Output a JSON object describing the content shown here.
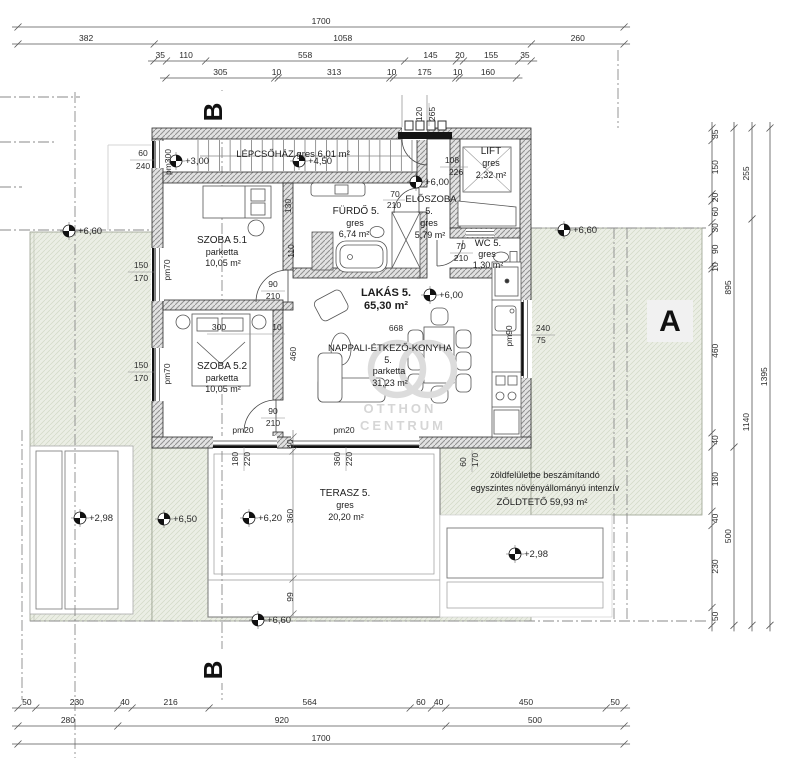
{
  "page": {
    "type": "architectural-floor-plan",
    "level": "emelet"
  },
  "watermark": {
    "monogram": "OC",
    "line1": "OTTHON",
    "line2": "CENTRUM"
  },
  "section_markers": [
    {
      "label": "B",
      "x": 222,
      "y": 112,
      "r": -90,
      "s": 26
    },
    {
      "label": "B",
      "x": 222,
      "y": 670,
      "r": -90,
      "s": 26
    },
    {
      "label": "A",
      "x": 670,
      "y": 331,
      "r": 0,
      "s": 30
    }
  ],
  "level_markers": [
    {
      "value": "+3,00",
      "x": 176,
      "y": 161
    },
    {
      "value": "+4,50",
      "x": 299,
      "y": 161
    },
    {
      "value": "+6,00",
      "x": 416,
      "y": 182
    },
    {
      "value": "+6,00",
      "x": 430,
      "y": 295
    },
    {
      "value": "+6,60",
      "x": 69,
      "y": 231
    },
    {
      "value": "+6,60",
      "x": 564,
      "y": 230
    },
    {
      "value": "+2,98",
      "x": 80,
      "y": 518
    },
    {
      "value": "+6,50",
      "x": 164,
      "y": 519
    },
    {
      "value": "+6,20",
      "x": 249,
      "y": 518
    },
    {
      "value": "+2,98",
      "x": 515,
      "y": 554
    },
    {
      "value": "+6,60",
      "x": 258,
      "y": 620
    }
  ],
  "room_labels": [
    {
      "t": "LÉPCSŐHÁZ gres 6,01 m²",
      "x": 293,
      "y": 157,
      "s": 9.5
    },
    {
      "t": "SZOBA 5.1",
      "x": 222,
      "y": 243,
      "s": 10
    },
    {
      "t": "parketta",
      "x": 222,
      "y": 255,
      "s": 9
    },
    {
      "t": "10,05 m²",
      "x": 223,
      "y": 266,
      "s": 9
    },
    {
      "t": "FÜRDŐ 5.",
      "x": 356,
      "y": 214,
      "s": 10
    },
    {
      "t": "gres",
      "x": 355,
      "y": 226,
      "s": 9
    },
    {
      "t": "6,74 m²",
      "x": 354,
      "y": 237,
      "s": 9
    },
    {
      "t": "ELŐSZOBA",
      "x": 431,
      "y": 202,
      "s": 9.5
    },
    {
      "t": "5.",
      "x": 429,
      "y": 214,
      "s": 9
    },
    {
      "t": "gres",
      "x": 429,
      "y": 226,
      "s": 9
    },
    {
      "t": "5,79 m²",
      "x": 430,
      "y": 238,
      "s": 9
    },
    {
      "t": "LIFT",
      "x": 491,
      "y": 154,
      "s": 10
    },
    {
      "t": "gres",
      "x": 491,
      "y": 166,
      "s": 9
    },
    {
      "t": "2,32 m²",
      "x": 491,
      "y": 178,
      "s": 9
    },
    {
      "t": "WC 5.",
      "x": 488,
      "y": 246,
      "s": 9.5
    },
    {
      "t": "gres",
      "x": 487,
      "y": 257,
      "s": 9
    },
    {
      "t": "1,30 m²",
      "x": 488,
      "y": 268,
      "s": 9
    },
    {
      "t": "LAKÁS 5.",
      "x": 386,
      "y": 296,
      "s": 11,
      "b": 1
    },
    {
      "t": "65,30 m²",
      "x": 386,
      "y": 309,
      "s": 11,
      "b": 1
    },
    {
      "t": "NAPPALI-ÉTKEZŐ-KONYHA",
      "x": 390,
      "y": 351,
      "s": 9.5
    },
    {
      "t": "5.",
      "x": 388,
      "y": 363,
      "s": 9
    },
    {
      "t": "parketta",
      "x": 389,
      "y": 374,
      "s": 9
    },
    {
      "t": "31,23 m²",
      "x": 390,
      "y": 386,
      "s": 9
    },
    {
      "t": "SZOBA 5.2",
      "x": 222,
      "y": 369,
      "s": 10
    },
    {
      "t": "parketta",
      "x": 222,
      "y": 381,
      "s": 9
    },
    {
      "t": "10,05 m²",
      "x": 223,
      "y": 392,
      "s": 9
    },
    {
      "t": "TERASZ 5.",
      "x": 345,
      "y": 496,
      "s": 10
    },
    {
      "t": "gres",
      "x": 345,
      "y": 508,
      "s": 9
    },
    {
      "t": "20,20 m²",
      "x": 346,
      "y": 520,
      "s": 9
    },
    {
      "t": "zöldfelületbe beszámítandó",
      "x": 545,
      "y": 478,
      "s": 9
    },
    {
      "t": "egyszintes növényállományú intenzív",
      "x": 545,
      "y": 491,
      "s": 9
    },
    {
      "t": "ZÖLDTETŐ   59,93 m²",
      "x": 542,
      "y": 505,
      "s": 9.5
    }
  ],
  "small_dims": [
    {
      "t": "120",
      "x": 422,
      "y": 114,
      "r": -90
    },
    {
      "t": "265",
      "x": 435,
      "y": 114,
      "r": -90
    },
    {
      "t": "60",
      "x": 143,
      "y": 156
    },
    {
      "t": "240",
      "x": 143,
      "y": 169
    },
    {
      "t": "pm300",
      "x": 171,
      "y": 162,
      "r": -90
    },
    {
      "t": "108",
      "x": 452,
      "y": 163
    },
    {
      "t": "226",
      "x": 456,
      "y": 175
    },
    {
      "t": "70",
      "x": 395,
      "y": 197
    },
    {
      "t": "210",
      "x": 394,
      "y": 208
    },
    {
      "t": "130",
      "x": 291,
      "y": 206,
      "r": -90
    },
    {
      "t": "110",
      "x": 294,
      "y": 251,
      "r": -90
    },
    {
      "t": "150",
      "x": 141,
      "y": 268
    },
    {
      "t": "170",
      "x": 141,
      "y": 281
    },
    {
      "t": "pm70",
      "x": 170,
      "y": 270,
      "r": -90
    },
    {
      "t": "90",
      "x": 273,
      "y": 287
    },
    {
      "t": "210",
      "x": 273,
      "y": 299
    },
    {
      "t": "70",
      "x": 461,
      "y": 249
    },
    {
      "t": "210",
      "x": 461,
      "y": 261
    },
    {
      "t": "300",
      "x": 219,
      "y": 330
    },
    {
      "t": "10",
      "x": 277,
      "y": 330
    },
    {
      "t": "460",
      "x": 296,
      "y": 354,
      "r": -90
    },
    {
      "t": "668",
      "x": 396,
      "y": 331
    },
    {
      "t": "240",
      "x": 543,
      "y": 331
    },
    {
      "t": "75",
      "x": 541,
      "y": 343
    },
    {
      "t": "pm90",
      "x": 512,
      "y": 336,
      "r": -90
    },
    {
      "t": "150",
      "x": 141,
      "y": 368
    },
    {
      "t": "170",
      "x": 141,
      "y": 381
    },
    {
      "t": "pm70",
      "x": 170,
      "y": 374,
      "r": -90
    },
    {
      "t": "90",
      "x": 273,
      "y": 414
    },
    {
      "t": "210",
      "x": 273,
      "y": 426
    },
    {
      "t": "pm20",
      "x": 243,
      "y": 433
    },
    {
      "t": "pm20",
      "x": 344,
      "y": 433
    },
    {
      "t": "180",
      "x": 238,
      "y": 459,
      "r": -90
    },
    {
      "t": "220",
      "x": 250,
      "y": 459,
      "r": -90
    },
    {
      "t": "40",
      "x": 293,
      "y": 444,
      "r": -90
    },
    {
      "t": "360",
      "x": 340,
      "y": 459,
      "r": -90
    },
    {
      "t": "220",
      "x": 352,
      "y": 459,
      "r": -90
    },
    {
      "t": "60",
      "x": 466,
      "y": 462,
      "r": -90
    },
    {
      "t": "170",
      "x": 478,
      "y": 460,
      "r": -90
    },
    {
      "t": "360",
      "x": 293,
      "y": 516,
      "r": -90
    },
    {
      "t": "99",
      "x": 293,
      "y": 597,
      "r": -90
    }
  ],
  "dim_chains": [
    {
      "dir": "h",
      "x": 18,
      "y": 27,
      "values": [
        1700
      ]
    },
    {
      "dir": "h",
      "x": 18,
      "y": 44,
      "values": [
        382,
        1058,
        260
      ]
    },
    {
      "dir": "h",
      "x": 154,
      "y": 61,
      "values": [
        35,
        110,
        558,
        145,
        20,
        155,
        35
      ]
    },
    {
      "dir": "h",
      "x": 166,
      "y": 78,
      "values": [
        305,
        10,
        313,
        10,
        175,
        10,
        160
      ]
    },
    {
      "dir": "h",
      "x": 18,
      "y": 708,
      "values": [
        50,
        230,
        40,
        216,
        564,
        60,
        40,
        450,
        50
      ]
    },
    {
      "dir": "h",
      "x": 18,
      "y": 726,
      "values": [
        280,
        920,
        500
      ]
    },
    {
      "dir": "h",
      "x": 18,
      "y": 744,
      "values": [
        1700
      ]
    },
    {
      "dir": "v",
      "x": 712,
      "y": 128,
      "side": 6,
      "values": [
        35,
        150,
        20,
        60,
        30,
        90,
        10,
        460,
        40,
        180,
        40,
        230,
        50
      ]
    },
    {
      "dir": "v",
      "x": 734,
      "y": 128,
      "side": -3,
      "values": [
        895,
        500
      ]
    },
    {
      "dir": "v",
      "x": 752,
      "y": 128,
      "side": -3,
      "values": [
        255,
        1140
      ]
    },
    {
      "dir": "v",
      "x": 770,
      "y": 128,
      "side": -3,
      "values": [
        1395
      ]
    }
  ]
}
